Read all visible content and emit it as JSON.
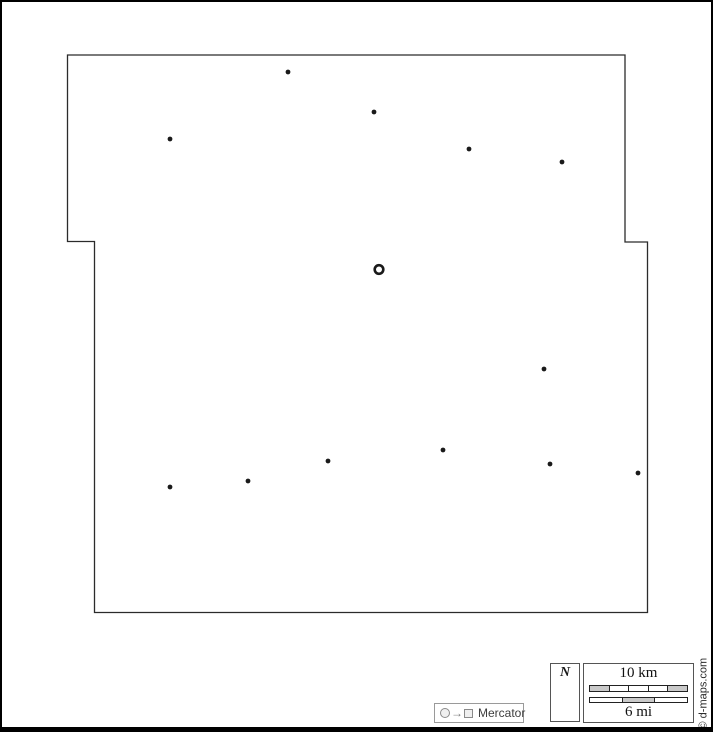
{
  "map": {
    "credit": "© d-maps.com",
    "outline_points": "65.5,53 623,53 623,240 645.5,240 645.5,610.5 92.5,610.5 92.5,239.5 65.5,239.5",
    "outline_color": "#2b2b2b",
    "dot_color": "#1a1a1a",
    "dot_radius": 2.4,
    "towns": [
      [
        286,
        70
      ],
      [
        372,
        110
      ],
      [
        168,
        137
      ],
      [
        467,
        147
      ],
      [
        560,
        160
      ],
      [
        542,
        367
      ],
      [
        441,
        448
      ],
      [
        326,
        459
      ],
      [
        548,
        462
      ],
      [
        636,
        471
      ],
      [
        246,
        479
      ],
      [
        168,
        485
      ]
    ],
    "seat": {
      "x": 377,
      "y": 267.5,
      "outer_radius": 4.3,
      "stroke_width": 2.6
    }
  },
  "compass": {
    "label": "N"
  },
  "scalebar": {
    "km_label": "10 km",
    "mi_label": "6 mi",
    "km_segment_colors": [
      "#c9c9c9",
      "#ffffff",
      "#ffffff",
      "#ffffff",
      "#c9c9c9"
    ],
    "mi_segment_colors": [
      "#ffffff",
      "#c9c9c9",
      "#ffffff"
    ]
  },
  "legend": {
    "label": "Mercator",
    "arrow": "→"
  }
}
